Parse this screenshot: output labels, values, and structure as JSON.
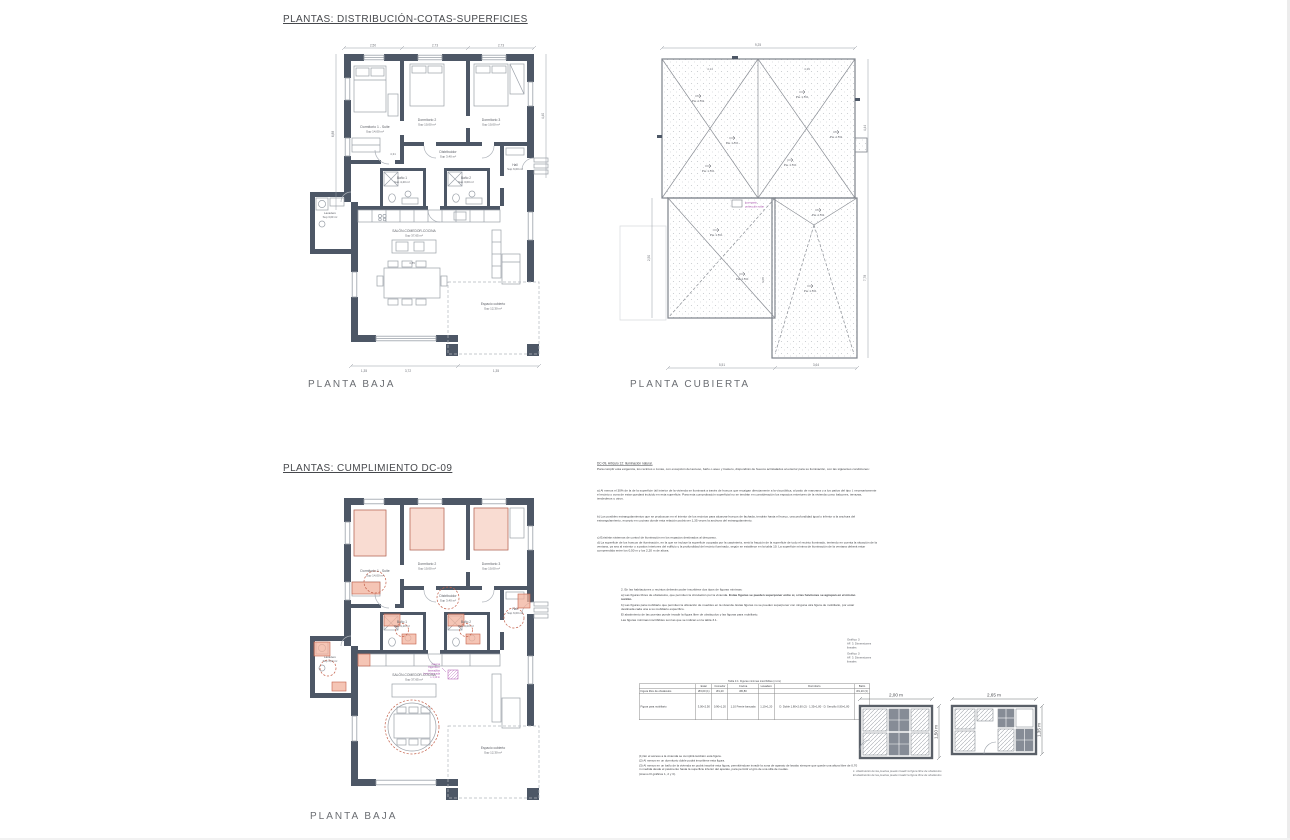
{
  "titles": {
    "sheet1": "PLANTAS: DISTRIBUCIÓN-COTAS-SUPERFICIES",
    "sheet2": "PLANTAS: CUMPLIMIENTO DC-09"
  },
  "labels": {
    "planta_baja": "PLANTA BAJA",
    "planta_cubierta": "PLANTA CUBIERTA"
  },
  "rooms": [
    {
      "name": "Dormitorio 1 - Suite",
      "area": "Sup 14,00 m²"
    },
    {
      "name": "Dormitorio 2",
      "area": "Sup 10,00 m²"
    },
    {
      "name": "Dormitorio 3",
      "area": "Sup 10,00 m²"
    },
    {
      "name": "Distribuidor",
      "area": "Sup 3,40 m²"
    },
    {
      "name": "Baño 1",
      "area": "Sup 4,40 m²"
    },
    {
      "name": "Baño 2",
      "area": "Sup 3,00 m²"
    },
    {
      "name": "Hall",
      "area": "Sup 6,00 m²"
    },
    {
      "name": "Lavadero",
      "area": "Sup 3,00 m²"
    },
    {
      "name": "SALÓN-COMEDOR-COCINA",
      "area": "Sup 37,65 m²"
    },
    {
      "name": "Espacio cubierto",
      "area": "Sup 12,30 m²"
    }
  ],
  "plan_dims": {
    "top": [
      "2,50",
      "2,73",
      "2,73"
    ],
    "left": "6,88",
    "right": "4,40",
    "bottom": [
      "1,35",
      "3,72",
      "1,35"
    ],
    "inner": [
      "4,31",
      "4,85"
    ]
  },
  "roof": {
    "pte": "Pte 1.5%",
    "dims": {
      "top": "9,25",
      "right": [
        "4,44",
        "7,78"
      ],
      "left": "2,50",
      "bottom": [
        "5,51",
        "3,64"
      ],
      "inner": "6,08",
      "halves": [
        "4,14",
        "4,29"
      ]
    },
    "legend": [
      "lucernario",
      "protección solar"
    ]
  },
  "plan2": {
    "annotation": [
      "reserva",
      "frigorífico /",
      "lavavajillas",
      "frente bancada",
      "≥ 1,10 m"
    ]
  },
  "dc09": {
    "heading": "DC-09, Artículo 12: Iluminación natural.",
    "intro": "Para cumplir esta exigencia, los recintos o zonas, con excepción del acceso, baño o aseo y trastero, dispondrán de huecos acristalados al exterior para su iluminación, con las siguientes condiciones:",
    "p_a": "a) Al menos el 30% de la de la superficie útil interior de la vivienda se iluminará a través de huecos que recaigan directamente a la vía pública, al patio de manzana o a los patios del tipo I, necesariamente el recinto o zona de estar quedará incluido en esta superficie. Para esta comprobación superficial no se tendrán en consideración los espacios exteriores de la vivienda como balcones, terrazas, tendederos u otros.",
    "p_b": "b) Los posibles estrangulamientos que se produzcan en el interior de los recintos para alcanzar huecos de fachada, tendrán hasta el hueco, una profundidad igual o inferior a la anchura del estrangulamiento, excepto en cocinas donde esta relación podrá ser 1,35 veces la anchura del estrangulamiento.",
    "p_c": "c) Existirán sistemas de control de iluminación en los espacios destinados al descanso.",
    "p_d": "d) La superficie de los huecos de iluminación, en la que se incluye la superficie ocupada por la carpintería, será la fracción de la superficie de todo el recinto iluminado, teniendo en cuenta la situación de la ventana, ya sea al exterior o a patios interiores del edificio y la profundidad del recinto iluminado, según se establece en la tabla 10. La superficie mínima de iluminación de la ventana deberá estar comprendida entre los 0,50 m y los 2,20 m de altura.",
    "sec2": {
      "l1": "2. En las habitaciones o recintos deberán poder inscribirse dos tipos de figuras mínimas:",
      "l2": "a) Las figuras libres de obstáculos, que permiten la circulación por la vivienda.",
      "l2b": "Estas figuras se pueden superponer entre sí, si las funciones se agrupan en el mismo recinto.",
      "l3": "b) Las figuras para mobiliario que permiten la ubicación de muebles en la vivienda. Estas figuras no se pueden superponer con ninguna otra figura de mobiliario, por estar destinada cada una a su mobiliario específico.",
      "l4": "El abatimiento de las puertas puede invadir la figura libre de obstáculos y las figuras para mobiliario.",
      "l5": "Las figuras mínimas inscribibles son las que se indican en la tabla 3.1."
    },
    "graf": [
      "Gráfico 3",
      "AF. 3. Dimensiones lineales"
    ],
    "table": {
      "caption": "Tabla 3.1: Figuras mínimas inscribibles (m×m)",
      "headers": [
        "",
        "Estar",
        "Comedor",
        "Cocina",
        "Lavadero",
        "Dormitorio",
        "Baño"
      ],
      "rows": [
        {
          "label": "Figura libre de obstáculos",
          "cells": [
            "Ø3,00 (1)",
            "Ø1,20",
            "Ø0,80",
            "",
            "",
            "Ø1,20 (3)"
          ]
        },
        {
          "label": "Figura para mobiliario",
          "cells": [
            "3,00×2,50",
            "0,90×1,20",
            "1,10 Frente bancada",
            "1,10×1,20",
            "D. Doble 1,80×2,60 (2) · 1,35×1,80 · D. Sencillo 0,90×1,80",
            ""
          ]
        }
      ]
    },
    "notes": [
      "(1) En el acceso a la vivienda se cumplirá también esta figura.",
      "(2) Al menos en un dormitorio doble podrá inscribirse esta figura.",
      "(3) Al menos en un baño de la vivienda se podrá inscribir esta figura, permitiéndose invadir la zona de aparato de lavabo siempre que quede una altura libre de 0,70 m medida desde el pavimento hasta la superficie inferior del aparato, para permitir el giro de una silla de ruedas.",
      "(Anexo III gráficos 1, 2 y 3)."
    ],
    "diagrams": {
      "d1_w": "2,00 m",
      "d1_h": "1,50 m",
      "d2_w": "2,65 m",
      "d2_h": "1,35 m",
      "caption1": "1. Abatimiento de las puertas puede invadir la figura libre de obstáculos",
      "caption2": "El abatimiento de las puertas puede invadir la figura libre de obstáculos"
    }
  },
  "colors": {
    "wall": "#4d5766",
    "salmon": "#f2b19c",
    "accent": "#c4604a",
    "magenta": "#a94fae"
  }
}
